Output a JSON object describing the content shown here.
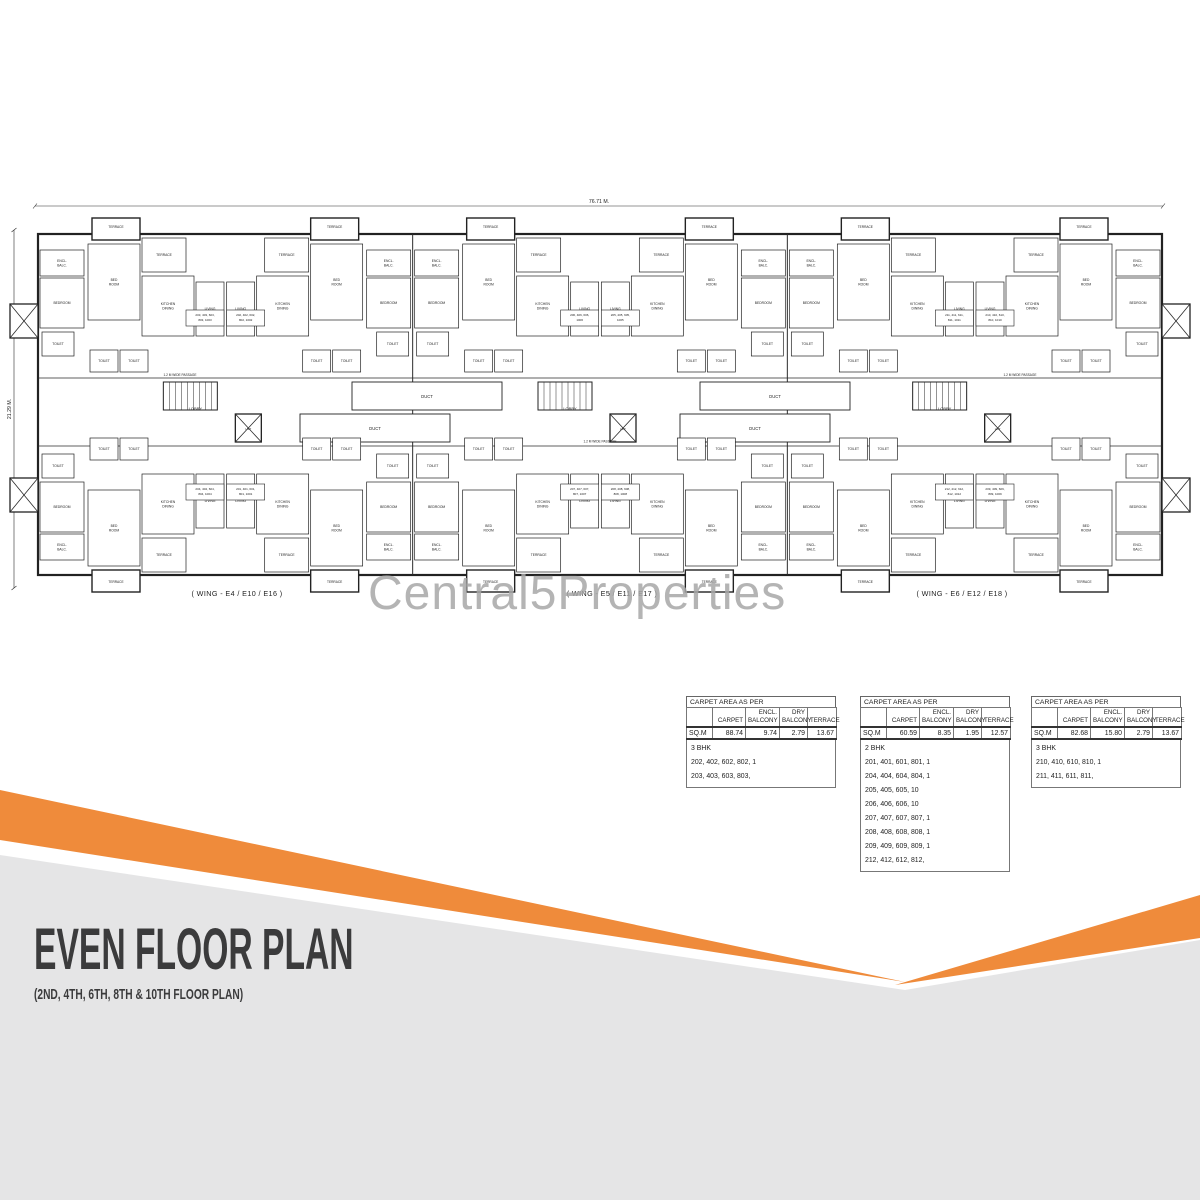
{
  "watermark": "Central5Properties",
  "plan": {
    "top_dimension": "76.71 M.",
    "left_dimension": "21.29 M.",
    "passage_label": "1.2 M WIDE PASSAGE",
    "lobby_label": "LOBBY",
    "lift_label": "LIFT",
    "duct_label": "DUCT",
    "terrace_label": "TERRACE",
    "wing_labels": [
      {
        "text": "( WING - E4 / E10 / E16 )",
        "x": 237,
        "y": 404
      },
      {
        "text": "( WING - E5 / E11 / E17 )",
        "x": 612,
        "y": 404
      },
      {
        "text": "( WING - E6 / E12 / E18 )",
        "x": 962,
        "y": 404
      }
    ],
    "module_rooms": [
      {
        "x": 2,
        "y": 58,
        "w": 44,
        "h": 26,
        "lines": [
          "ENCL.",
          "BALC."
        ]
      },
      {
        "x": 2,
        "y": 86,
        "w": 44,
        "h": 50,
        "lines": [
          "BEDROOM"
        ]
      },
      {
        "x": 4,
        "y": 140,
        "w": 32,
        "h": 24,
        "lines": [
          "TOILET"
        ]
      },
      {
        "x": 50,
        "y": 52,
        "w": 52,
        "h": 76,
        "lines": [
          "BED",
          "ROOM"
        ]
      },
      {
        "x": 104,
        "y": 46,
        "w": 44,
        "h": 34,
        "lines": [
          "TERRACE"
        ]
      },
      {
        "x": 104,
        "y": 84,
        "w": 52,
        "h": 60,
        "lines": [
          "KITCHEN",
          "DINING"
        ]
      },
      {
        "x": 158,
        "y": 90,
        "w": 28,
        "h": 54,
        "lines": [
          "LIVING"
        ]
      },
      {
        "x": 52,
        "y": 158,
        "w": 28,
        "h": 22,
        "lines": [
          "TOILET"
        ]
      },
      {
        "x": 82,
        "y": 158,
        "w": 28,
        "h": 22,
        "lines": [
          "TOILET"
        ]
      }
    ],
    "unit_box": {
      "x": 148,
      "y": 118,
      "w": 38,
      "h": 16
    },
    "unit_numbers": [
      [
        "203, 403, 603,",
        "803, 1003"
      ],
      [
        "202, 402, 602,",
        "802, 1002"
      ],
      [
        "204, 404, 604,",
        "804, 1004"
      ],
      [
        "201, 401, 601,",
        "801, 1001"
      ],
      [
        "206, 406, 606,",
        "1006"
      ],
      [
        "205, 405, 605,",
        "1005"
      ],
      [
        "207, 407, 607,",
        "807, 1007"
      ],
      [
        "208, 408, 608,",
        "808, 1008"
      ],
      [
        "211, 411, 611,",
        "811, 1011"
      ],
      [
        "210, 410, 610,",
        "810, 1010"
      ],
      [
        "212, 412, 612,",
        "812, 1012"
      ],
      [
        "209, 409, 609,",
        "809, 1009"
      ]
    ]
  },
  "tables": [
    {
      "left": 686,
      "top": 696,
      "title": "CARPET AREA AS PER",
      "columns": [
        "",
        "CARPET",
        "ENCL. BALCONY",
        "DRY BALCONY",
        "TERRACE"
      ],
      "unit_row": [
        "SQ.M",
        "88.74",
        "9.74",
        "2.79",
        "13.67"
      ],
      "list_heading": "3 BHK",
      "list_lines": [
        "202, 402, 602, 802, 1",
        "203, 403, 603, 803,"
      ]
    },
    {
      "left": 860,
      "top": 696,
      "title": "CARPET AREA AS PER",
      "columns": [
        "",
        "CARPET",
        "ENCL. BALCONY",
        "DRY BALCONY",
        "TERRACE"
      ],
      "unit_row": [
        "SQ.M",
        "60.59",
        "8.35",
        "1.95",
        "12.57"
      ],
      "list_heading": "2 BHK",
      "list_lines": [
        "201, 401, 601, 801, 1",
        "204, 404, 604, 804, 1",
        "205, 405, 605, 10",
        "206, 406, 606, 10",
        "207, 407, 607, 807, 1",
        "208, 408, 608, 808, 1",
        "209, 409, 609, 809, 1",
        "212, 412, 612, 812,"
      ]
    },
    {
      "left": 1031,
      "top": 696,
      "title": "CARPET AREA AS PER",
      "columns": [
        "",
        "CARPET",
        "ENCL. BALCONY",
        "DRY BALCONY",
        "TERRACE"
      ],
      "unit_row": [
        "SQ.M",
        "82.68",
        "15.80",
        "2.79",
        "13.67"
      ],
      "list_heading": "3 BHK",
      "list_lines": [
        "210, 410, 610, 810, 1",
        "211, 411, 611, 811,"
      ]
    }
  ],
  "banner": {
    "title": "EVEN FLOOR PLAN",
    "subtitle": "(2ND, 4TH, 6TH, 8TH & 10TH FLOOR PLAN)",
    "orange": "#ef8b3b",
    "gray": "#e5e5e6",
    "title_color": "#3b3b3c"
  }
}
